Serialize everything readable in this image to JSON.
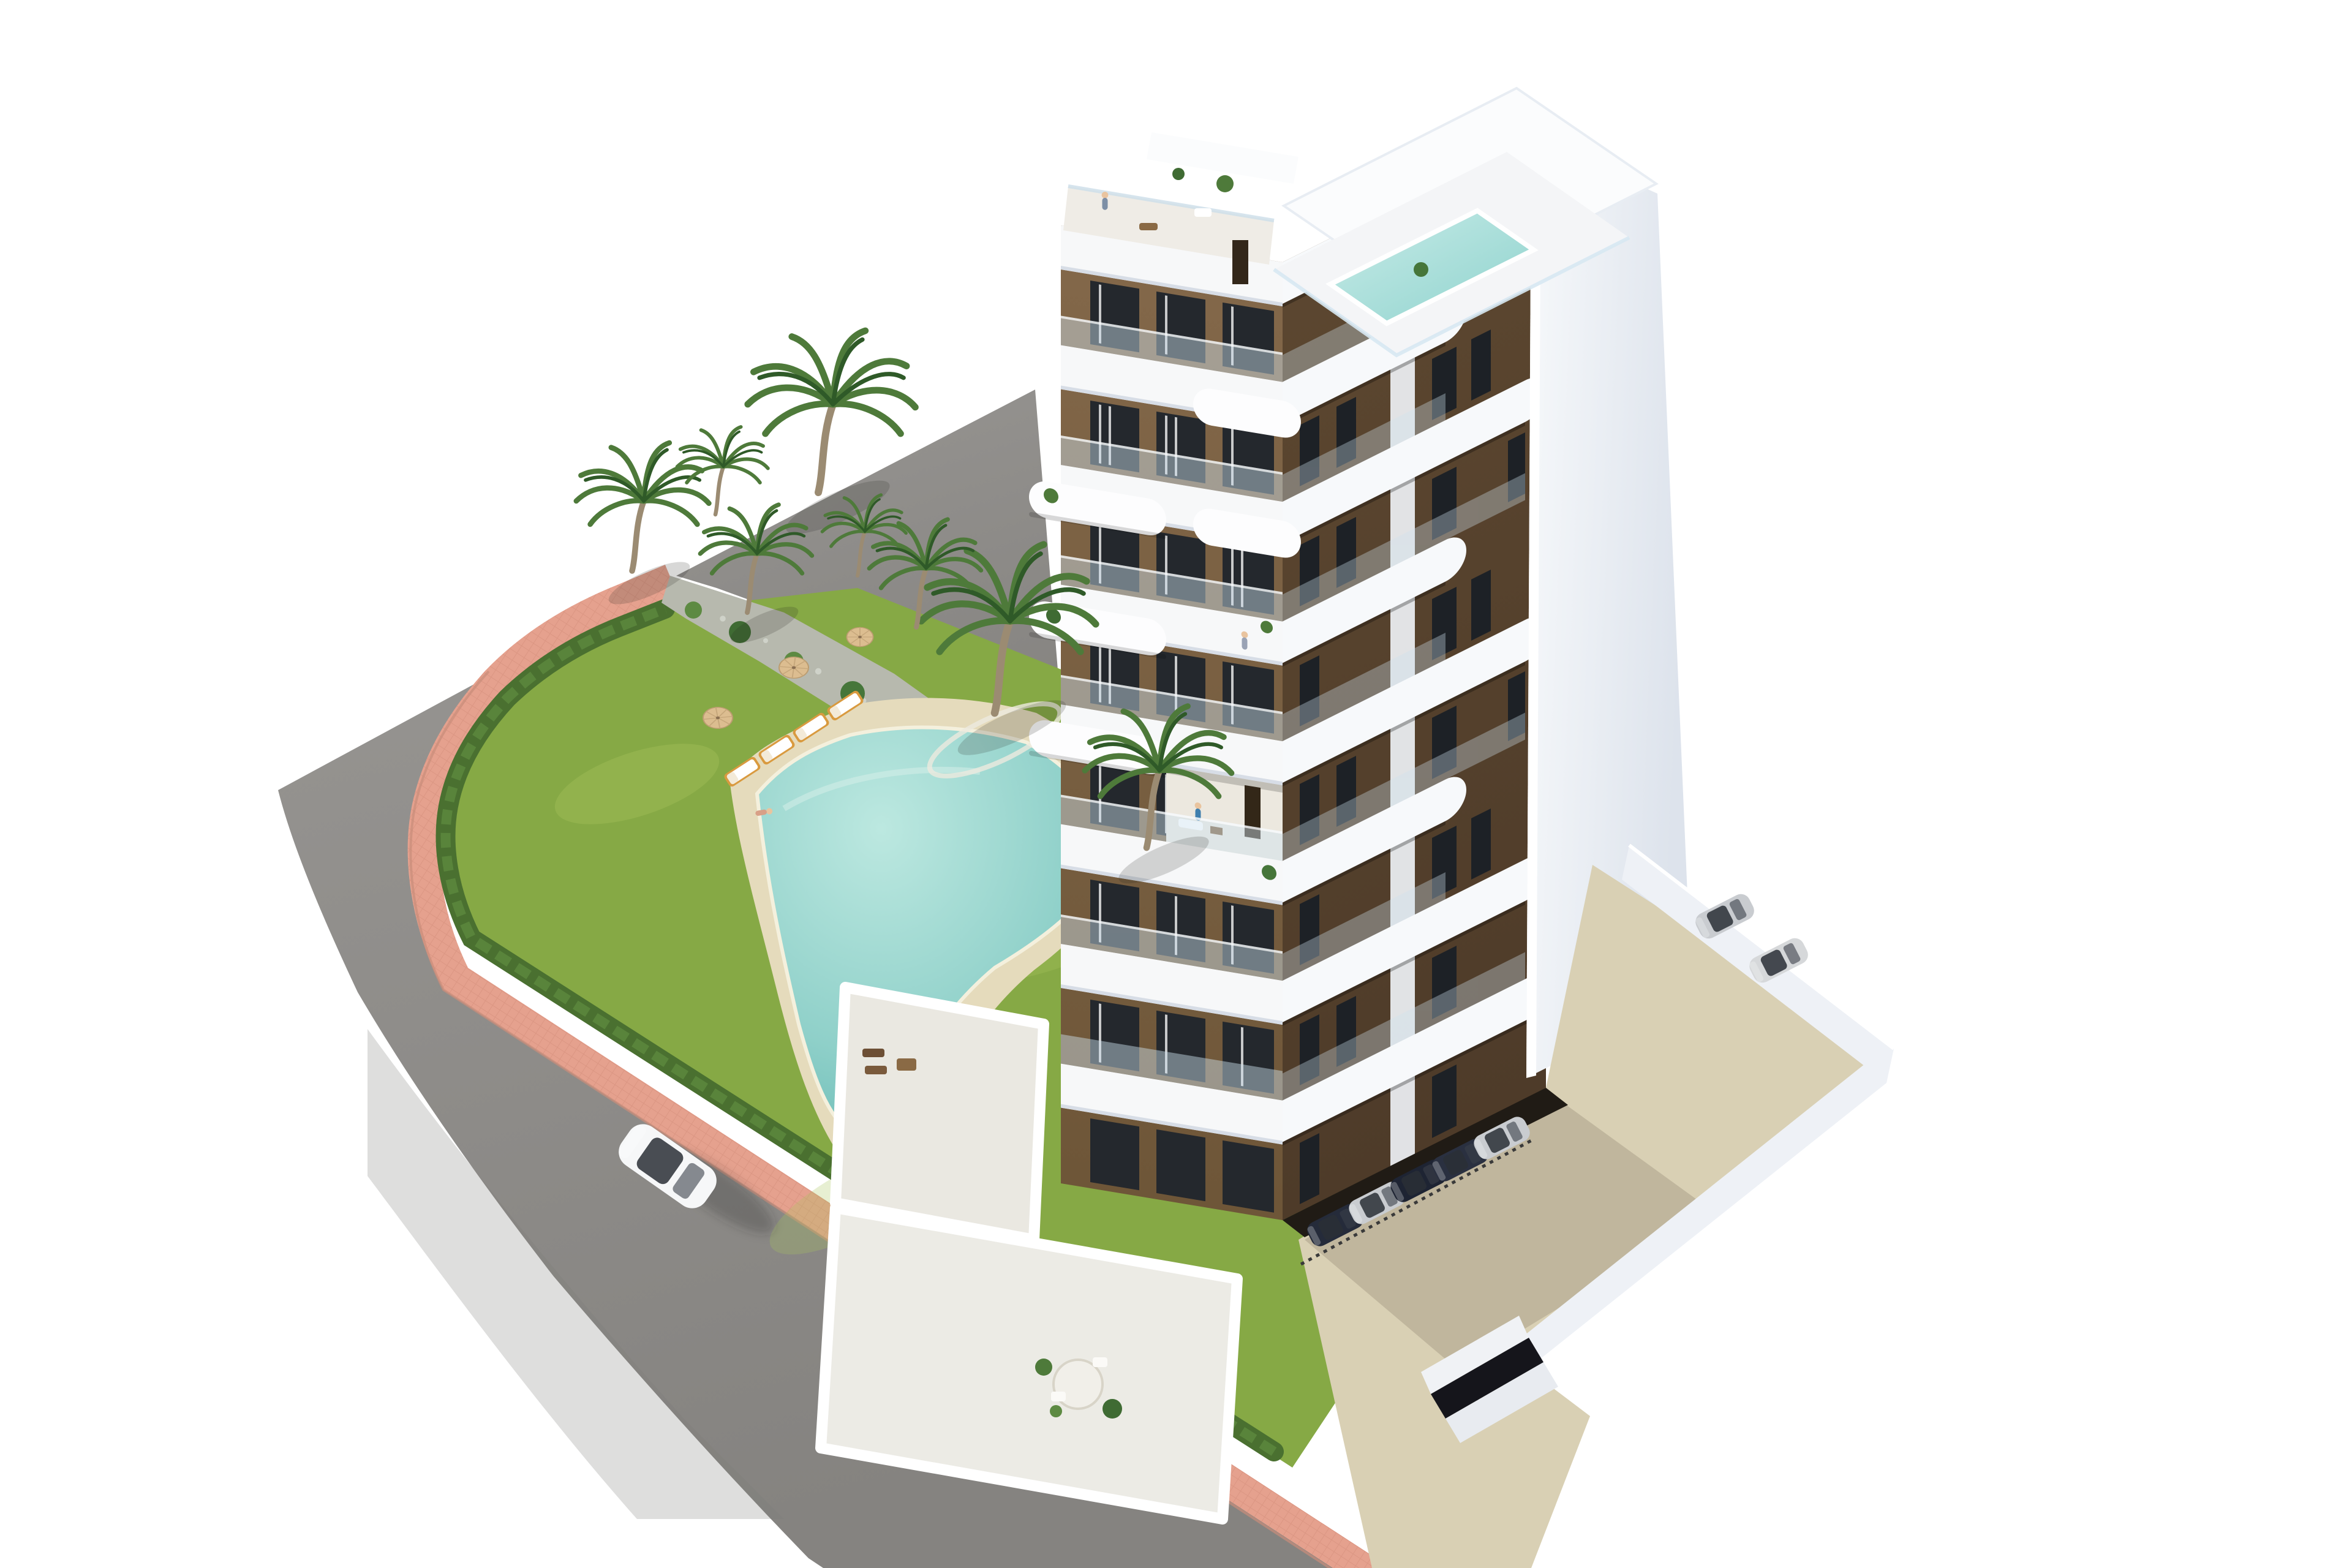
{
  "scene": {
    "description": "Aerial 3D architectural rendering of a modern eight-storey apartment building with white curved balcony bands and brown facades, a rooftop terrace with private plunge pool, a landscaped garden with free-form communal swimming pool, sun loungers and parasols, palm trees, a pink tiled promenade beside a curving asphalt road with a white sedan, and a private parking area with parked cars.",
    "building": {
      "floors": 8,
      "balcony_style": "white rounded cantilevered bands with glass balustrades",
      "facade_finish": "brown stucco with floor-to-ceiling dark windows",
      "rooftop": "roof terrace with plunge pool, plants and lounge furniture",
      "side_wall": "tall plain white gable wall",
      "ground_level": "walled private terraces and under-croft parking"
    },
    "amenities": {
      "communal_pool": "free-form turquoise pool with sand-coloured deck",
      "sun_loungers": 4,
      "parasols": 3,
      "palm_trees": 8,
      "perimeter": "green hedge and pink tiled walkway"
    },
    "vehicles": {
      "driving_cars": 1,
      "driving_car_color": "white",
      "parked_silver_cars": 2,
      "undercroft_cars": 5
    },
    "people_visible": 7
  },
  "palette": {
    "asphalt": "#908e8b",
    "asphalt_dark": "#7d7b78",
    "sidewalk_pink": "#e5a18e",
    "sidewalk_pink_dark": "#c98d7a",
    "hedge_green": "#4a7030",
    "hedge_light": "#5d8a3e",
    "lawn_green": "#86a945",
    "lawn_light": "#a9c45c",
    "gravel": "#b7b9ae",
    "deck_sand": "#e5dbbc",
    "pool_aqua": "#8fd0c9",
    "pool_aqua_deep": "#57b0ac",
    "facade_brown": "#83684a",
    "facade_brown_dark": "#4e3b29",
    "window_dark": "#24282d",
    "glass": "#cfe2ef",
    "white_wall": "#f4f6f9",
    "wall_shade": "#dde3ec",
    "trunk_brown": "#9b8b72",
    "palm_green": "#4e7a3a",
    "palm_green_dark": "#2f5a28",
    "car_white": "#f6f7f8",
    "car_silver": "#c9ccd0",
    "car_dark": "#252b3a",
    "concrete": "#d9d0b4",
    "terrace_floor": "#eae8e1"
  }
}
